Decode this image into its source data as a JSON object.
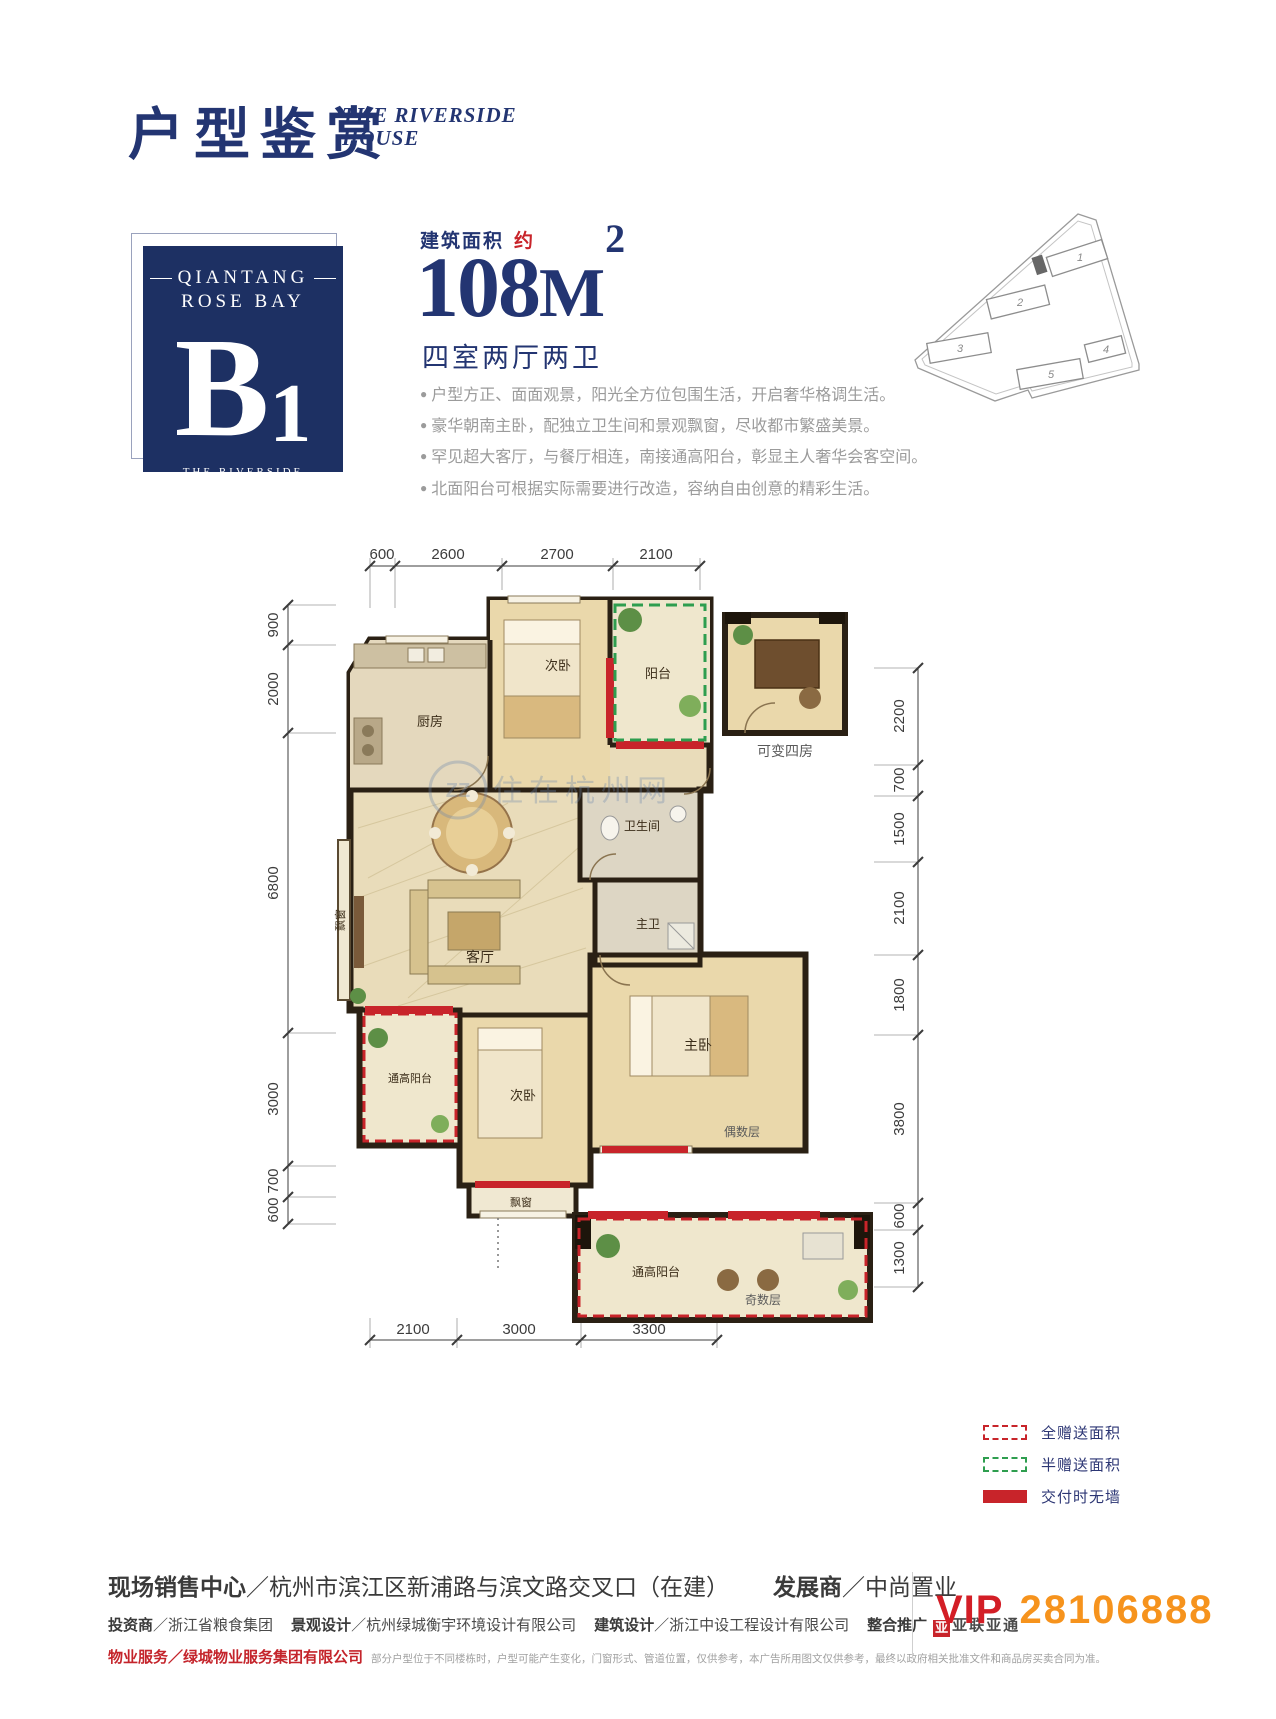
{
  "header": {
    "title": "户型鉴赏",
    "subtitle1": "THE RIVERSIDE",
    "subtitle2": "HOUSE"
  },
  "unit_card": {
    "brand1": "QIANTANG",
    "brand2": "ROSE BAY",
    "unit": "B",
    "unit_sub": "1",
    "cap1": "THE RIVERSIDE",
    "cap2": "HOUSE"
  },
  "area": {
    "label": "建筑面积",
    "approx": "约",
    "value": "108",
    "m": "M",
    "sup": "2",
    "layout": "四室两厅两卫"
  },
  "bullet": "●",
  "features": [
    "户型方正、面面观景，阳光全方位包围生活，开启奢华格调生活。",
    "豪华朝南主卧，配独立卫生间和景观飘窗，尽收都市繁盛美景。",
    "罕见超大客厅，与餐厅相连，南接通高阳台，彰显主人奢华会客空间。",
    "北面阳台可根据实际需要进行改造，容纳自由创意的精彩生活。"
  ],
  "site_map": {
    "buildings": [
      "1",
      "2",
      "3",
      "4",
      "5"
    ]
  },
  "floor_plan": {
    "dims_top": [
      "600",
      "2600",
      "2700",
      "2100"
    ],
    "dims_left": [
      "900",
      "2000",
      "6800",
      "3000",
      "700",
      "600"
    ],
    "dims_right": [
      "2200",
      "700",
      "1500",
      "2100",
      "1800",
      "3800",
      "600",
      "1300"
    ],
    "dims_bottom": [
      "2100",
      "3000",
      "3300"
    ],
    "rooms": {
      "kitchen": "厨房",
      "bedroom_top": "次卧",
      "balcony_top": "阳台",
      "convertible_room": "可变四房",
      "bay_window_left": "飘窗",
      "living": "客厅",
      "bathroom": "卫生间",
      "master_bath": "主卫",
      "master_bedroom": "主卧",
      "bedroom_bottom": "次卧",
      "bay_window_bottom": "飘窗",
      "tall_balcony": "通高阳台",
      "tall_balcony_odd": "通高阳台",
      "even_floors": "偶数层",
      "odd_floors": "奇数层"
    },
    "watermark": {
      "logo": "ZZ",
      "text": "住在杭州网"
    }
  },
  "legend": {
    "items": [
      {
        "label": "全赠送面积"
      },
      {
        "label": "半赠送面积"
      },
      {
        "label": "交付时无墙"
      }
    ]
  },
  "footer": {
    "sep": "／",
    "line1_label1": "现场销售中心",
    "line1_value1": "杭州市滨江区新浦路与滨文路交叉口（在建）",
    "line1_label2": "发展商",
    "line1_value2": "中尚置业",
    "line2": [
      {
        "label": "投资商",
        "value": "浙江省粮食集团"
      },
      {
        "label": "景观设计",
        "value": "杭州绿城衡宇环境设计有限公司"
      },
      {
        "label": "建筑设计",
        "value": "浙江中设工程设计有限公司"
      }
    ],
    "promo_label": "整合推广",
    "promo_box": "亚",
    "promo_brand": "亚联亚通",
    "line3_label": "物业服务",
    "line3_value": "绿城物业服务集团有限公司",
    "disclaimer": "部分户型位于不同楼栋时，户型可能产生变化，门窗形式、管道位置，仅供参考，本广告所用图文仅供参考，最终以政府相关批准文件和商品房买卖合同为准。",
    "vip_label": "VIP",
    "vip_number": "28106888"
  },
  "colors": {
    "navy": "#233572",
    "red": "#c8242a",
    "orange": "#f6931d",
    "green": "#2e9e4f",
    "wall": "#2a2014"
  }
}
